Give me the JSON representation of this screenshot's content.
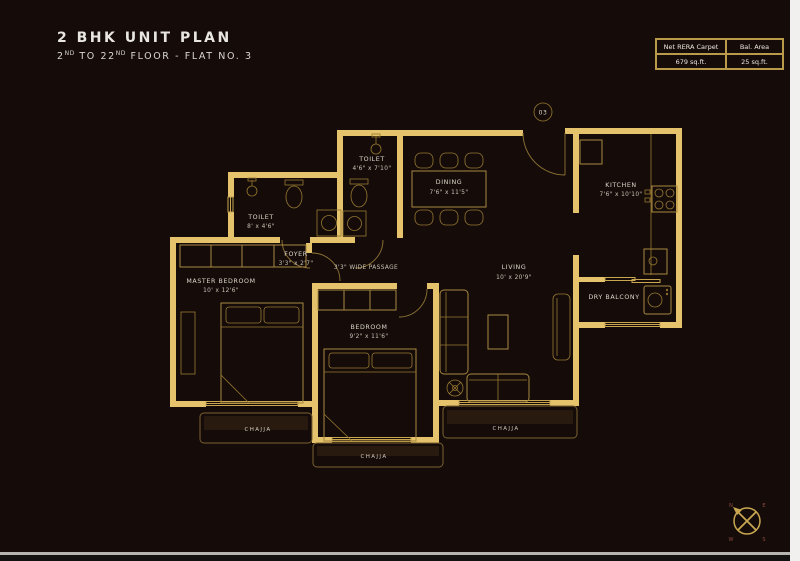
{
  "header": {
    "title": "2 BHK UNIT PLAN",
    "subtitle": {
      "t1": "2",
      "t2": "ND",
      "t3": " TO 22",
      "t4": "ND",
      "t5": " FLOOR - FLAT NO. 3"
    }
  },
  "area_table": {
    "col1_label": "Net RERA Carpet",
    "col1_value": "679 sq.ft.",
    "col2_label": "Bal. Area",
    "col2_value": "25 sq.ft."
  },
  "rooms": {
    "master_toilet": {
      "name": "TOILET",
      "dims": "8' x 4'6\""
    },
    "common_toilet": {
      "name": "TOILET",
      "dims": "4'6\" x 7'10\""
    },
    "dining": {
      "name": "DINING",
      "dims": "7'6\" x 11'5\""
    },
    "kitchen": {
      "name": "KITCHEN",
      "dims": "7'6\" x 10'10\""
    },
    "living": {
      "name": "LIVING",
      "dims": "10' x 20'9\""
    },
    "master_bedroom": {
      "name": "MASTER BEDROOM",
      "dims": "10' x 12'6\""
    },
    "bedroom": {
      "name": "BEDROOM",
      "dims": "9'2\" x 11'6\""
    },
    "foyer": {
      "name": "FOYER",
      "dims": "3'3\" x 2'7\""
    },
    "dry_balcony": {
      "name": "DRY BALCONY"
    },
    "passage": {
      "name": "3'3\" WIDE PASSAGE"
    }
  },
  "chajja": {
    "left": "CHAJJA",
    "center": "CHAJJA",
    "right": "CHAJJA"
  },
  "entry": {
    "flat_number": "03"
  },
  "compass": {
    "n": "N",
    "e": "E",
    "w": "W",
    "s": "S"
  },
  "colors": {
    "background": "#150c0a",
    "wall": "#e4c36c",
    "line": "#a8873d",
    "text": "#dcd7c9"
  }
}
